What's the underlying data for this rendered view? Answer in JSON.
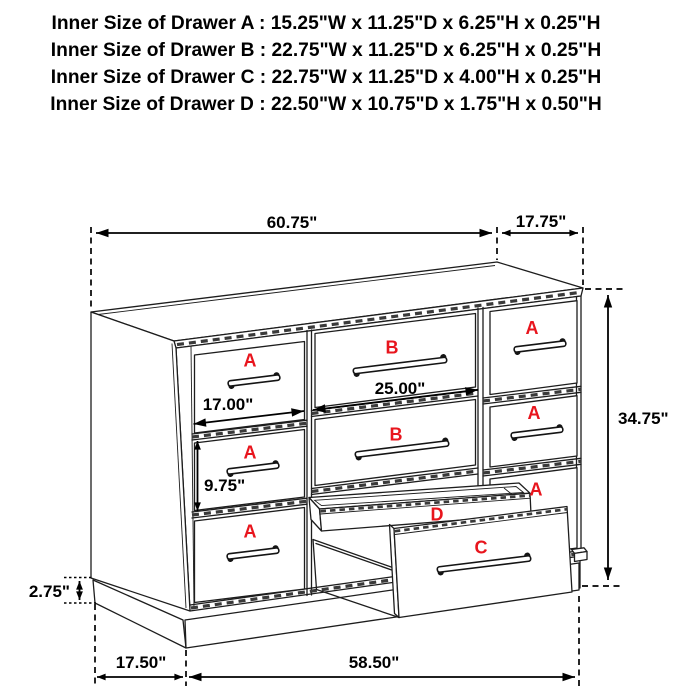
{
  "title": {
    "lines": [
      "Inner Size of Drawer A : 15.25\"W x 11.25\"D x 6.25\"H x 0.25\"H",
      "Inner Size of Drawer B : 22.75\"W x 11.25\"D x 6.25\"H x 0.25\"H",
      "Inner Size of Drawer C : 22.75\"W x 11.25\"D x 4.00\"H x 0.25\"H",
      "Inner Size of Drawer  D : 22.50\"W x 10.75\"D x 1.75\"H x 0.50\"H"
    ]
  },
  "diagram": {
    "drawer_labels": {
      "a": "A",
      "b": "B",
      "c": "C",
      "d": "D"
    },
    "dimensions": {
      "top_width": "60.75\"",
      "top_depth": "17.75\"",
      "overall_height": "34.75\"",
      "left_drawer_width": "17.00\"",
      "middle_drawer_width": "25.00\"",
      "drawer_height": "9.75\"",
      "plinth_height": "2.75\"",
      "base_depth": "17.50\"",
      "base_width": "58.50\""
    },
    "colors": {
      "label_red": "#e8151d",
      "line_dark": "#1d1d1d"
    }
  }
}
